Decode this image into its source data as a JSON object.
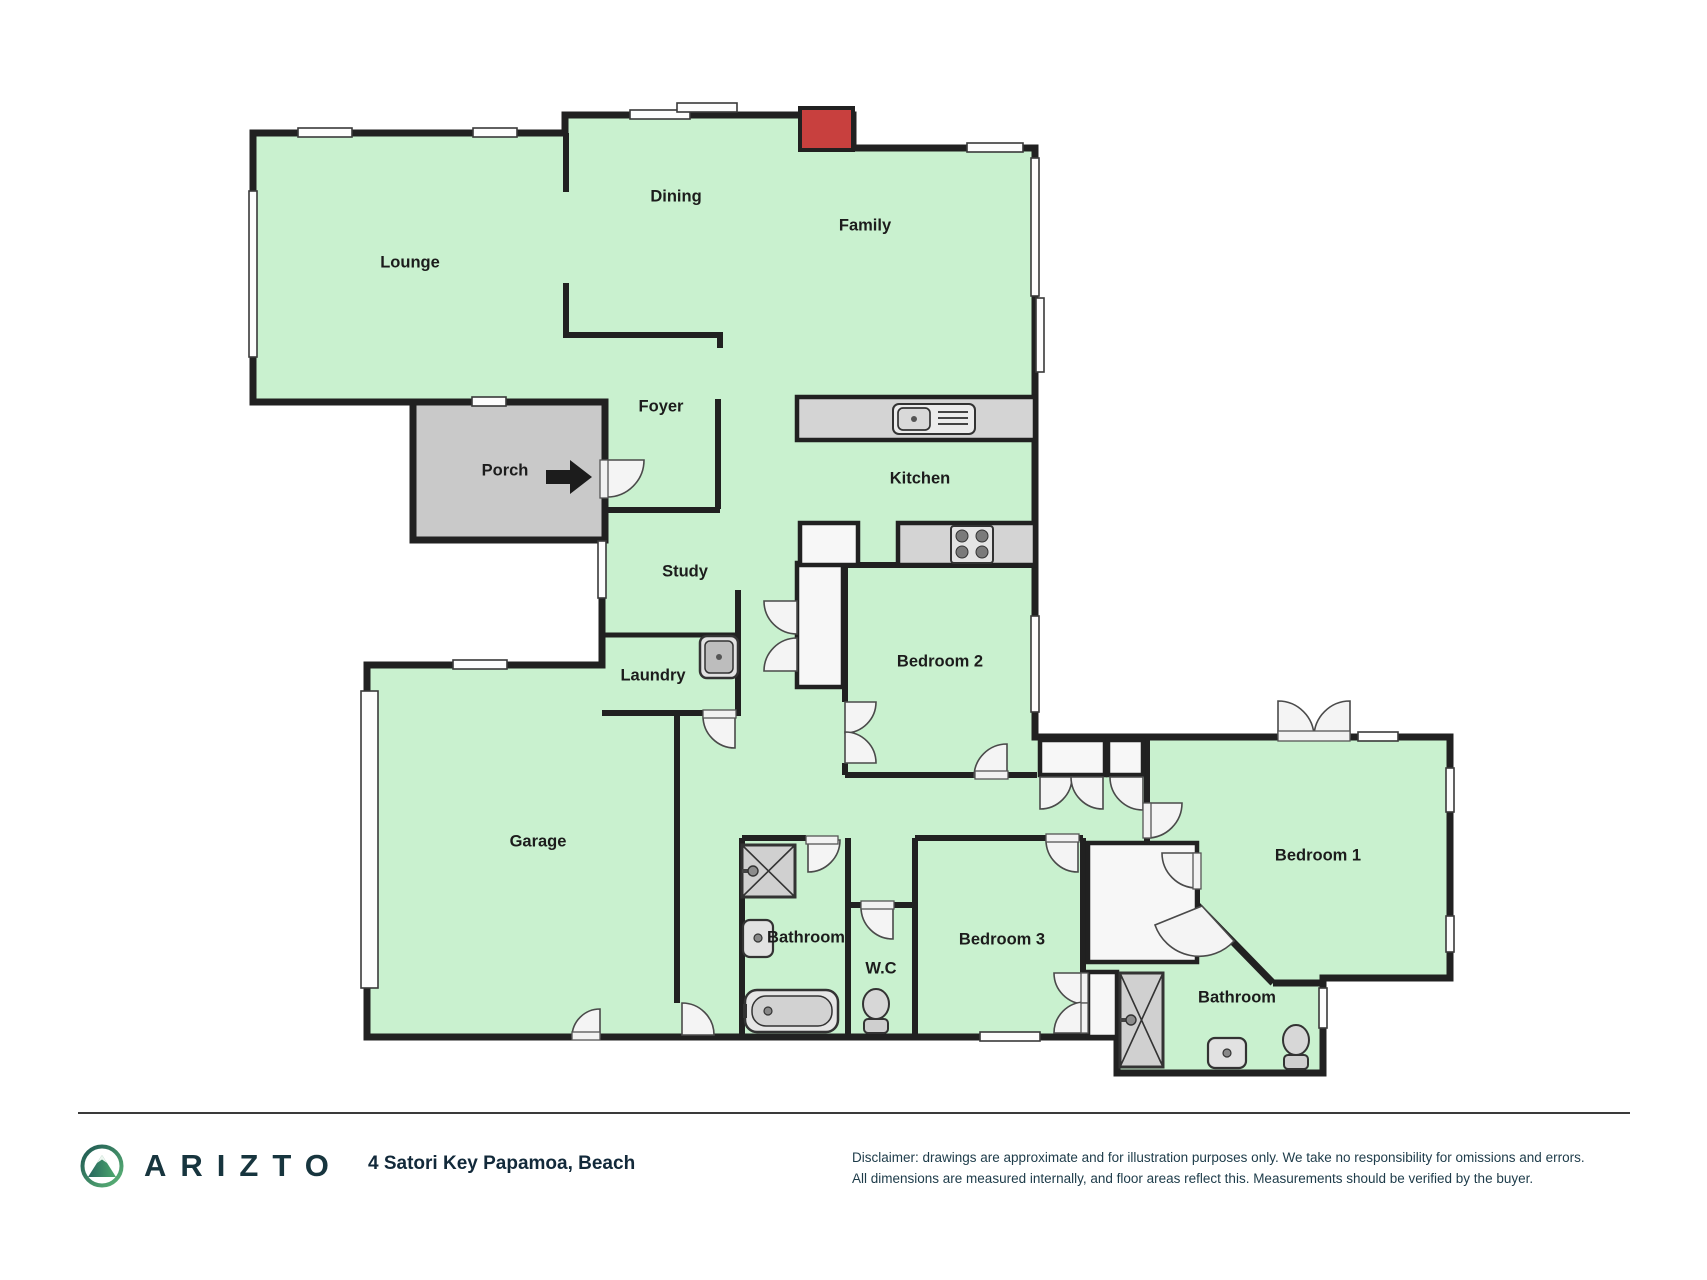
{
  "plan": {
    "rooms": [
      {
        "id": "lounge",
        "label": "Lounge",
        "x": 410,
        "y": 263
      },
      {
        "id": "dining",
        "label": "Dining",
        "x": 676,
        "y": 197
      },
      {
        "id": "family",
        "label": "Family",
        "x": 865,
        "y": 226
      },
      {
        "id": "foyer",
        "label": "Foyer",
        "x": 661,
        "y": 407
      },
      {
        "id": "porch",
        "label": "Porch",
        "x": 505,
        "y": 471
      },
      {
        "id": "kitchen",
        "label": "Kitchen",
        "x": 920,
        "y": 479
      },
      {
        "id": "study",
        "label": "Study",
        "x": 685,
        "y": 572
      },
      {
        "id": "laundry",
        "label": "Laundry",
        "x": 653,
        "y": 676
      },
      {
        "id": "garage",
        "label": "Garage",
        "x": 538,
        "y": 842
      },
      {
        "id": "bedroom-2",
        "label": "Bedroom 2",
        "x": 940,
        "y": 662
      },
      {
        "id": "bedroom-1",
        "label": "Bedroom 1",
        "x": 1318,
        "y": 856
      },
      {
        "id": "bedroom-3",
        "label": "Bedroom 3",
        "x": 1002,
        "y": 940
      },
      {
        "id": "bathroom",
        "label": "Bathroom",
        "x": 806,
        "y": 938
      },
      {
        "id": "wc",
        "label": "W.C",
        "x": 881,
        "y": 969
      },
      {
        "id": "bathroom-2",
        "label": "Bathroom",
        "x": 1237,
        "y": 998
      }
    ],
    "fixtures": [
      "fireplace",
      "kitchen-sink",
      "cooktop",
      "pantry",
      "laundry-tub",
      "shower",
      "vanity",
      "bathtub",
      "toilet",
      "ensuite-shower",
      "ensuite-vanity",
      "ensuite-toilet",
      "entry-arrow",
      "garage-door"
    ]
  },
  "footer": {
    "brand": "ARIZTO",
    "address": "4 Satori Key Papamoa, Beach",
    "disclaimer_line1": "Disclaimer: drawings are approximate and for illustration purposes only. We take no responsibility for omissions and errors.",
    "disclaimer_line2": "All dimensions are measured internally, and floor areas reflect this. Measurements should be verified by the buyer."
  },
  "colors": {
    "floor": "#c9f1cf",
    "wall": "#212121",
    "porch": "#c9c9c9",
    "counter": "#d4d4d4",
    "fixture_fill": "#e9e9e9",
    "accent_red": "#c8403e",
    "door": "#f4f4f4",
    "window": "#fdfdfd",
    "brand_dark": "#17353e",
    "logo_teal": "#1e5752",
    "logo_green": "#5cb577"
  }
}
